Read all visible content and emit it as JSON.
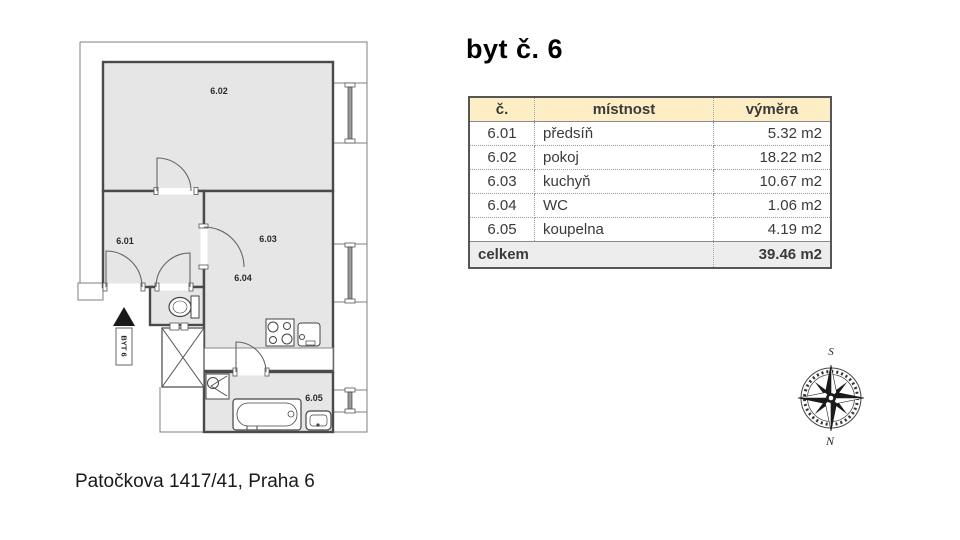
{
  "title": "byt č. 6",
  "address": "Patočkova 1417/41, Praha 6",
  "plan": {
    "arrow_label": "BYT 6",
    "room_labels": {
      "r601": "6.01",
      "r602": "6.02",
      "r603": "6.03",
      "r604": "6.04",
      "r605": "6.05"
    }
  },
  "compass": {
    "top": "S",
    "bottom": "N"
  },
  "table": {
    "headers": {
      "no": "č.",
      "room": "místnost",
      "area": "výměra"
    },
    "rows": [
      {
        "no": "6.01",
        "room": "předsíň",
        "area": "5.32 m2"
      },
      {
        "no": "6.02",
        "room": "pokoj",
        "area": "18.22 m2"
      },
      {
        "no": "6.03",
        "room": "kuchyň",
        "area": "10.67 m2"
      },
      {
        "no": "6.04",
        "room": "WC",
        "area": "1.06 m2"
      },
      {
        "no": "6.05",
        "room": "koupelna",
        "area": "4.19 m2"
      }
    ],
    "footer": {
      "label": "celkem",
      "area": "39.46 m2"
    }
  },
  "colors": {
    "header_bg": "#fdeec6",
    "footer_bg": "#ededed",
    "room_fill": "#e6e6e6",
    "wall": "#4a4a4a",
    "text": "#3a3a3a"
  }
}
